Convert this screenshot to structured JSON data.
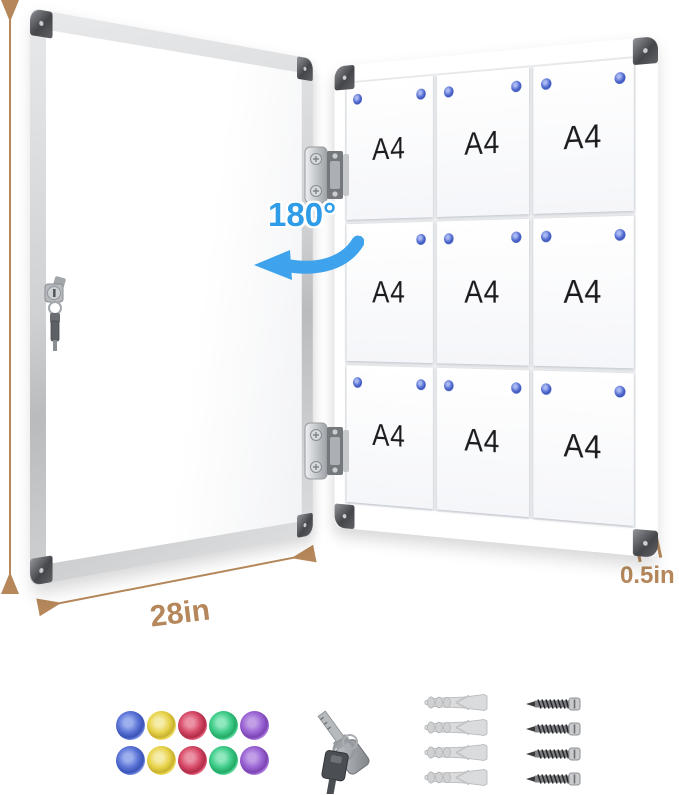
{
  "annotations": {
    "height_label": "38in",
    "width_label": "28in",
    "depth_label": "0.5in",
    "swing_label": "180°",
    "accent_tan": "#b5875a",
    "accent_blue": "#2f9ce8"
  },
  "board": {
    "sheet_label": "A4",
    "rows": 3,
    "cols": 3,
    "pin_colors": {
      "light": "#a8b8f0",
      "mid": "#5b74d6",
      "dark": "#3a53b4"
    }
  },
  "accessories": {
    "magnet_count": 10,
    "key_count": 2,
    "anchor_count": 4,
    "screw_count": 4,
    "magnet_colors": [
      {
        "name": "blue",
        "light": "#9db0ee",
        "mid": "#5b74d6",
        "dark": "#3a53b6",
        "rim": "#c2cdf4"
      },
      {
        "name": "yellow",
        "light": "#f6ecaa",
        "mid": "#e8d44c",
        "dark": "#c8b02e",
        "rim": "#f4ecb6"
      },
      {
        "name": "red",
        "light": "#ec92a6",
        "mid": "#d64a67",
        "dark": "#b02c48",
        "rim": "#f2b6c2"
      },
      {
        "name": "green",
        "light": "#90e8c0",
        "mid": "#3ecc88",
        "dark": "#24a866",
        "rim": "#b8eed6"
      },
      {
        "name": "purple",
        "light": "#c29ee6",
        "mid": "#9a64d4",
        "dark": "#7a44b2",
        "rim": "#d8c2ee"
      }
    ]
  }
}
